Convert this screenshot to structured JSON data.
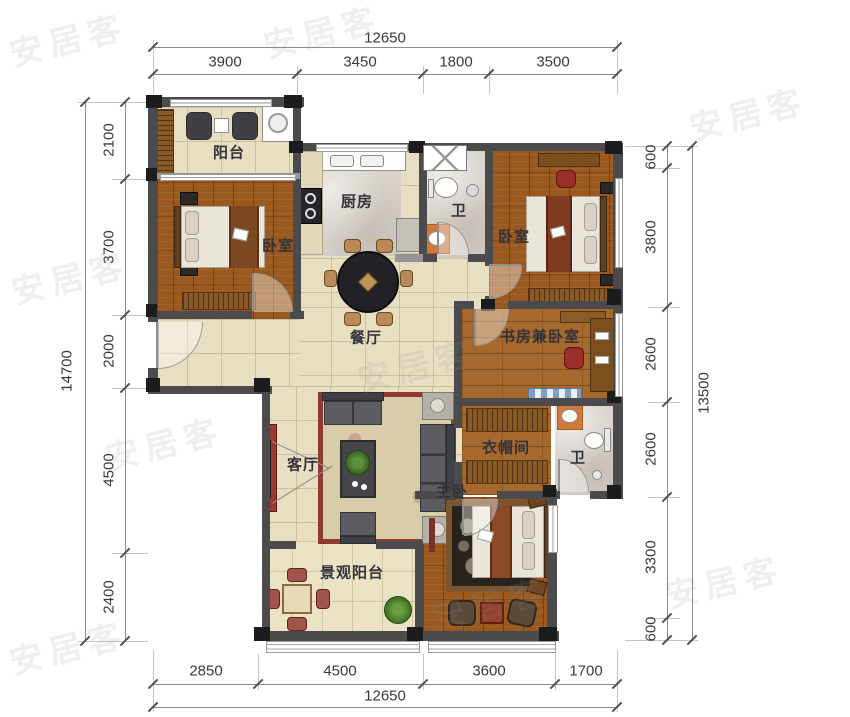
{
  "watermark": {
    "text": "安居客"
  },
  "dimensions": {
    "top": {
      "total": "12650",
      "segments": [
        "3900",
        "3450",
        "1800",
        "3500"
      ]
    },
    "bottom": {
      "total": "12650",
      "segments": [
        "2850",
        "4500",
        "3600",
        "1700"
      ]
    },
    "left": {
      "total": "14700",
      "segments": [
        "2100",
        "3700",
        "2000",
        "4500",
        "2400"
      ]
    },
    "right": {
      "total": "13500",
      "segments": [
        "600",
        "3800",
        "2600",
        "2600",
        "3300",
        "600"
      ]
    }
  },
  "rooms": {
    "balcony": "阳台",
    "bedroom_left": "卧室",
    "kitchen": "厨房",
    "bath_top": "卫",
    "bedroom_right": "卧室",
    "dining": "餐厅",
    "study": "书房兼卧室",
    "living": "客厅",
    "closet": "衣帽间",
    "bath_mid": "卫",
    "master": "主卧",
    "view_balcony": "景观阳台"
  },
  "colors": {
    "wall": "#4b4b4d",
    "wood_floor": "#99591f",
    "tile_floor": "#e8dfc2",
    "marble_floor": "#d8d2cb",
    "accent_red": "#9c3a30",
    "dimension_text": "#3a3a3a"
  }
}
